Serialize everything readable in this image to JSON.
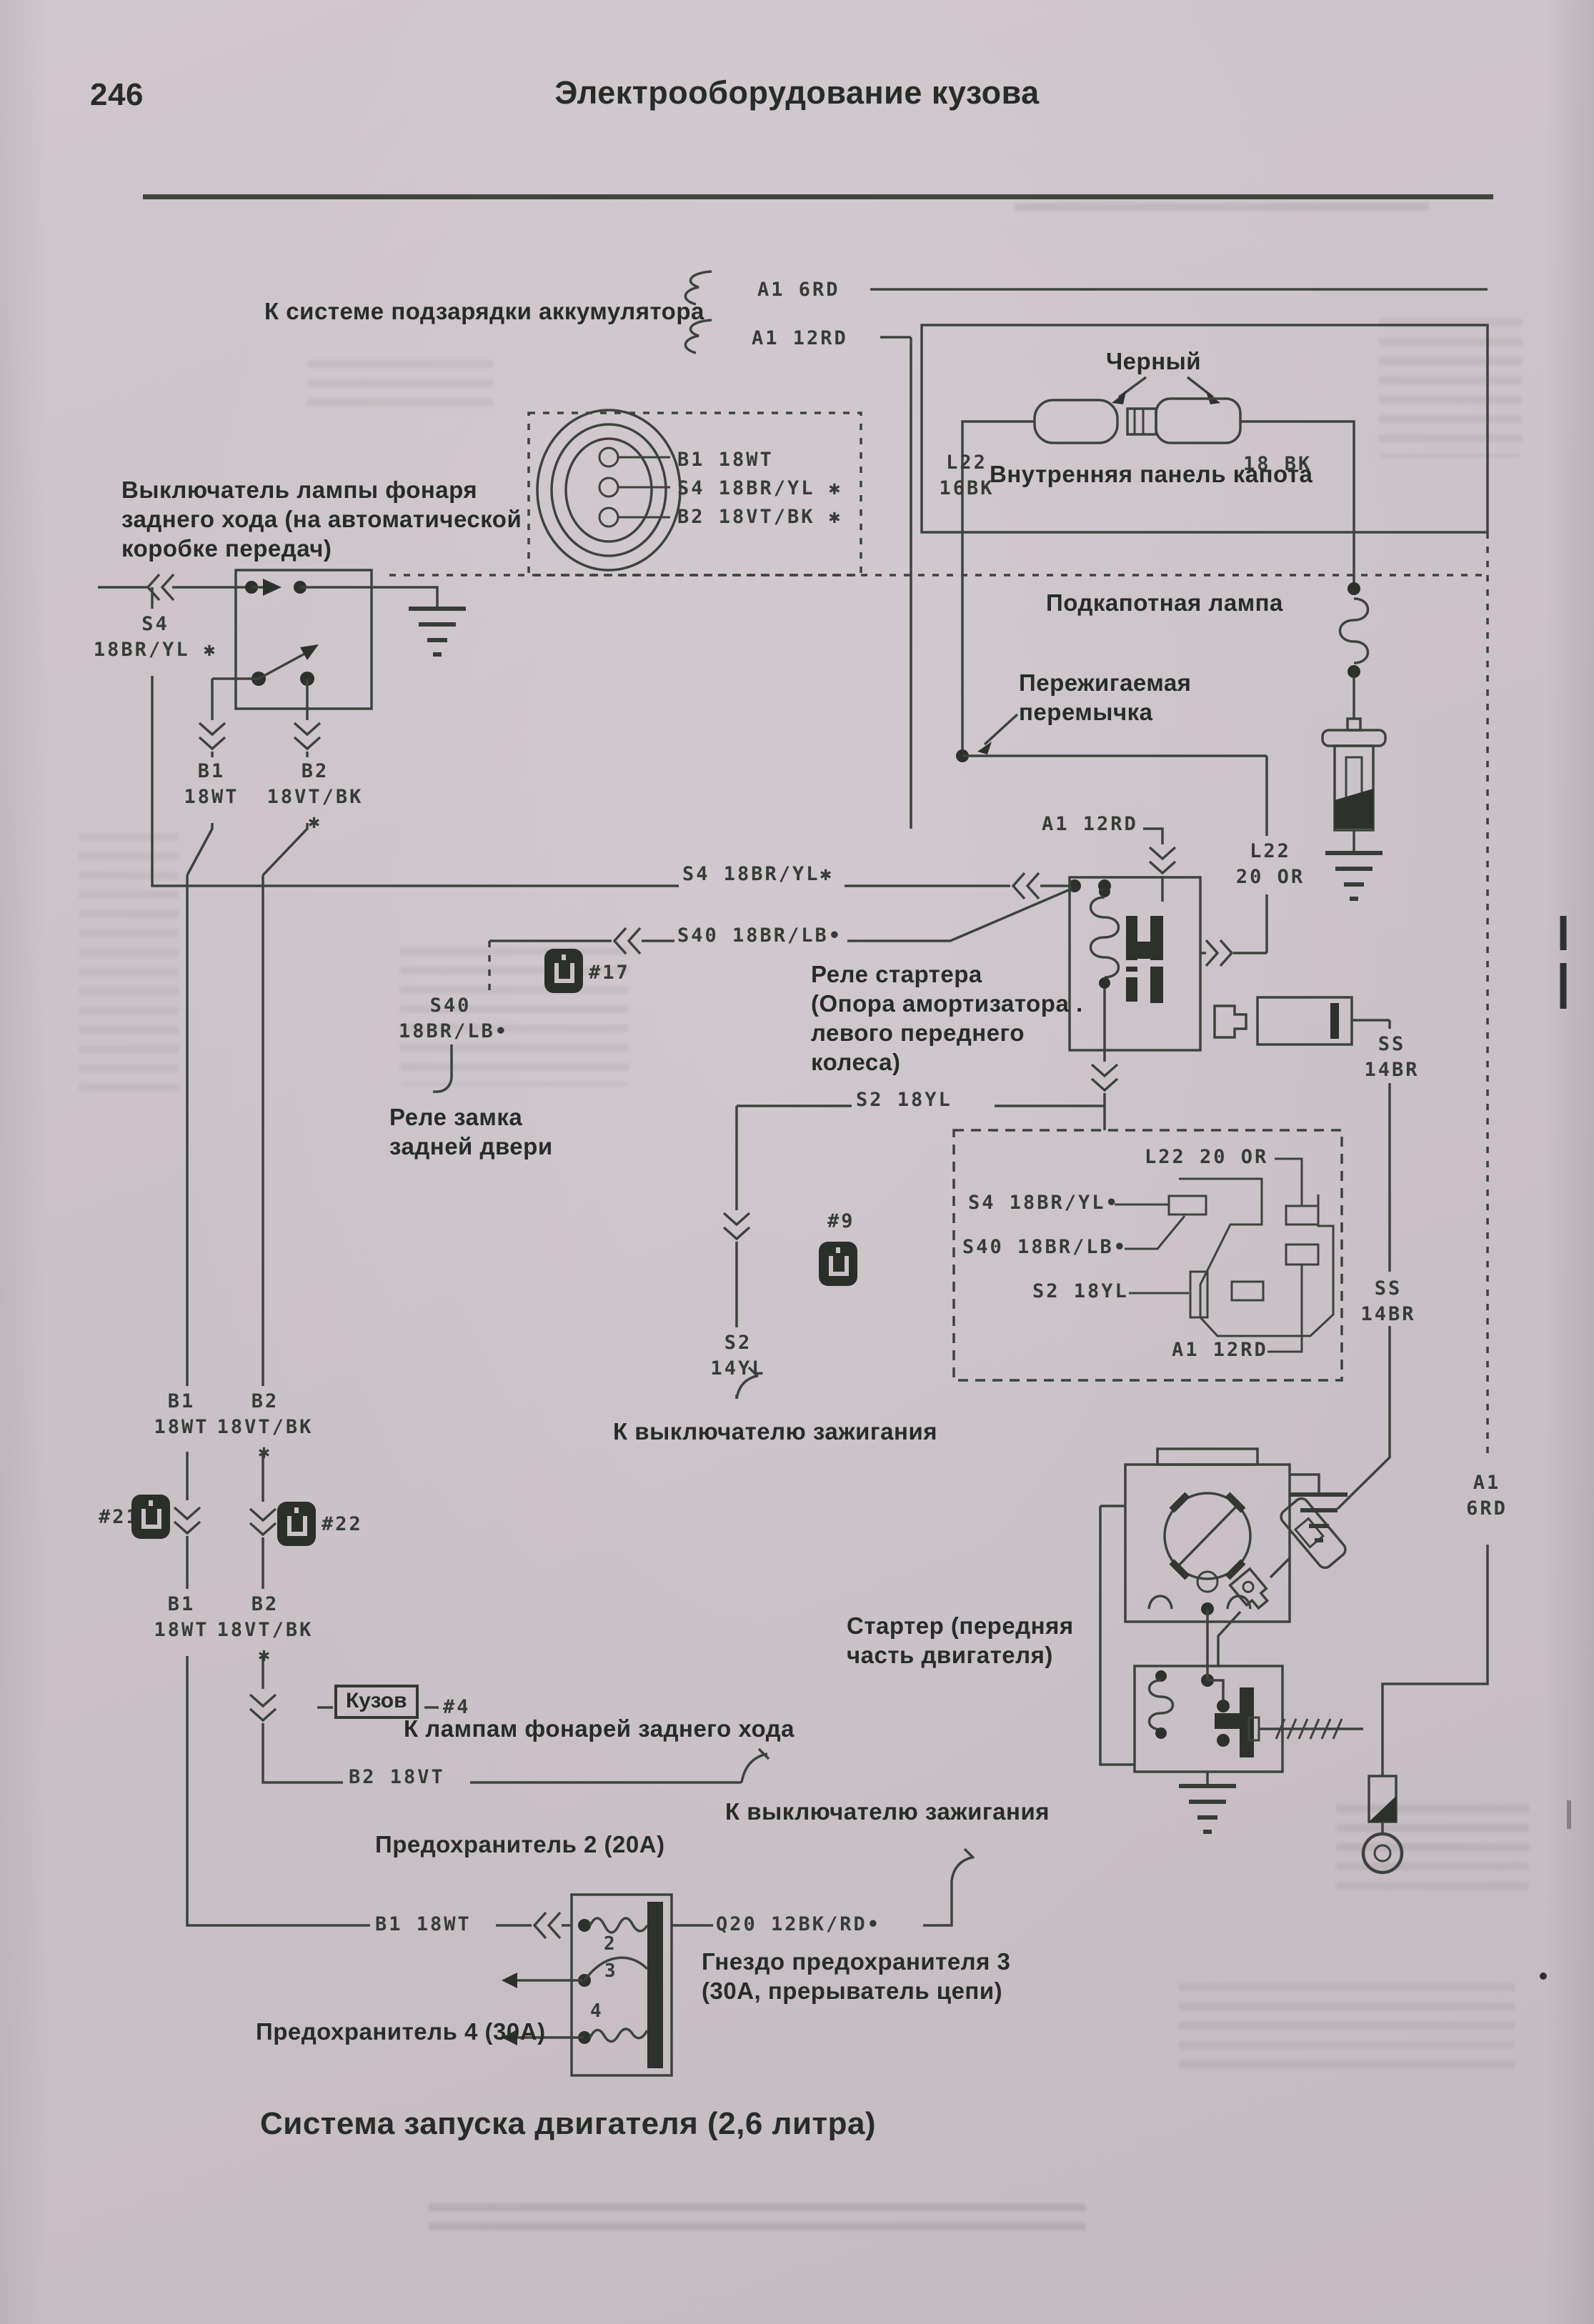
{
  "page": {
    "number": "246",
    "header": "Электрооборудование кузова",
    "title": "Система запуска двигателя (2,6 литра)"
  },
  "captions": {
    "to_charging": "К системе подзарядки аккумулятора",
    "black": "Черный",
    "inner_hood_panel": "Внутренняя панель капота",
    "underhood_lamp": "Подкапотная лампа",
    "fusible_link": "Пережигаемая\nперемычка",
    "reversing_switch": "Выключатель лампы фонаря\nзаднего хода (на автоматической\nкоробке передач)",
    "starter_relay": "Реле стартера\n(Опора амортизатора .\nлевого переднего\nколеса)",
    "rear_door_relay": "Реле замка\nзадней двери",
    "to_ignition_mid": "К выключателю зажигания",
    "starter": "Стартер (передняя\nчасть двигателя)",
    "to_reversing_lamps": "К лампам фонарей заднего хода",
    "to_ignition_bottom": "К выключателю зажигания",
    "fuse2": "Предохранитель 2 (20A)",
    "fuse3_socket": "Гнездо предохранителя 3\n(30A, прерыватель цепи)",
    "fuse4": "Предохранитель 4 (30A)",
    "kuzov": "Кузов"
  },
  "wires": {
    "a1_6rd_top": "A1 6RD",
    "a1_12rd_top": "A1 12RD",
    "l22_16bk": "L22\n16BK",
    "bk_18": "18 BK",
    "pin_b1": "B1 18WT",
    "pin_s4": "S4 18BR/YL ✱",
    "pin_b2": "B2 18VT/BK ✱",
    "s4_left": "S4\n18BR/YL ✱",
    "b1_upper": "B1\n18WT",
    "b2_upper": "B2\n18VT/BK ✱",
    "s4_row": "S4 18BR/YL✱",
    "s40_row": "S40 18BR/LB•",
    "a1_12rd_mid": "A1 12RD",
    "l22_20or": "L22\n20 OR",
    "s40_dangle": "S40\n18BR/LB•",
    "s2_row": "S2 18YL",
    "s2_col": "S2\n14YL",
    "ss_upper": "SS\n14BR",
    "ss_lower": "SS\n14BR",
    "dbox_l22": "L22 20 OR",
    "dbox_s4": "S4 18BR/YL•",
    "dbox_s40": "S40 18BR/LB•",
    "dbox_s2": "S2 18YL",
    "dbox_a1": "A1 12RD",
    "a1_6rd_bottom": "A1\n6RD",
    "b1_lower": "B1\n18WT",
    "b2_lower": "B2\n18VT/BK ✱",
    "b2_18vt": "B2 18VT",
    "b1_18wt": "B1 18WT",
    "q20": "Q20 12BK/RD•"
  },
  "connectors": {
    "c17": "#17",
    "c9": "#9",
    "c21": "#21",
    "c22": "#22",
    "c4": "#4",
    "fuse_2": "2",
    "fuse_3": "3",
    "fuse_4": "4"
  }
}
